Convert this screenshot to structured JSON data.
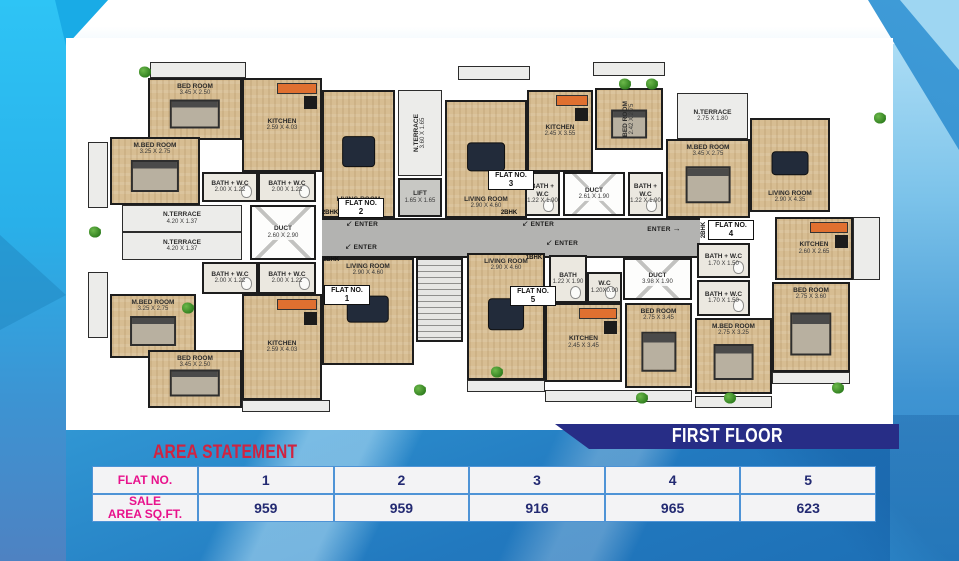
{
  "banner": {
    "title": "FIRST FLOOR"
  },
  "area_statement": {
    "title": "AREA STATEMENT",
    "rows": [
      {
        "label": "FLAT NO.",
        "cells": [
          "1",
          "2",
          "3",
          "4",
          "5"
        ]
      },
      {
        "label": "SALE\nAREA SQ.FT.",
        "cells": [
          "959",
          "959",
          "916",
          "965",
          "623"
        ]
      }
    ]
  },
  "colors": {
    "banner_navy": "#272d86",
    "title_red": "#d02340",
    "header_magenta": "#e8128c",
    "value_navy": "#232a72",
    "table_border_blue": "#4e93d6",
    "background_blue": "#35a0da",
    "left_band_cyan": "#2ec4f5"
  },
  "plan": {
    "flat_label": "FLAT NO.",
    "enter_text": "ENTER",
    "rooms": [
      {
        "t": "corridor",
        "x": 234,
        "y": 160,
        "w": 378,
        "h": 40
      },
      {
        "t": "stair",
        "x": 328,
        "y": 200,
        "w": 47,
        "h": 84
      },
      {
        "t": "terrace",
        "x": 62,
        "y": 4,
        "w": 96,
        "h": 16
      },
      {
        "t": "terrace",
        "x": 370,
        "y": 8,
        "w": 72,
        "h": 14
      },
      {
        "t": "terrace",
        "x": 505,
        "y": 4,
        "w": 72,
        "h": 14
      },
      {
        "t": "terrace",
        "x": 154,
        "y": 342,
        "w": 88,
        "h": 12
      },
      {
        "t": "terrace",
        "x": 379,
        "y": 322,
        "w": 78,
        "h": 12
      },
      {
        "t": "terrace",
        "x": 457,
        "y": 332,
        "w": 147,
        "h": 12
      },
      {
        "t": "terrace",
        "x": 607,
        "y": 338,
        "w": 77,
        "h": 12
      },
      {
        "t": "terrace",
        "x": 684,
        "y": 314,
        "w": 78,
        "h": 12
      },
      {
        "t": "terrace",
        "x": 0,
        "y": 84,
        "w": 20,
        "h": 66
      },
      {
        "t": "terrace",
        "x": 0,
        "y": 214,
        "w": 20,
        "h": 66
      },
      {
        "t": "terrace",
        "x": 765,
        "y": 159,
        "w": 27,
        "h": 63
      },
      {
        "n": "BED ROOM",
        "d": "3.45 X 2.50",
        "t": "wood",
        "f": "bed",
        "lp": "top",
        "x": 60,
        "y": 20,
        "w": 94,
        "h": 62
      },
      {
        "n": "M.BED ROOM",
        "d": "3.25 X 2.75",
        "t": "wood",
        "f": "bed",
        "lp": "top",
        "x": 22,
        "y": 79,
        "w": 90,
        "h": 68
      },
      {
        "n": "KITCHEN",
        "d": "2.59 X 4.03",
        "t": "wood",
        "f": "kit",
        "x": 154,
        "y": 20,
        "w": 80,
        "h": 94
      },
      {
        "n": "BATH + W.C",
        "d": "2.00 X 1.22",
        "t": "bath",
        "f": "wc",
        "x": 114,
        "y": 114,
        "w": 56,
        "h": 30
      },
      {
        "n": "BATH + W.C",
        "d": "2.00 X 1.22",
        "t": "bath",
        "f": "wc",
        "x": 170,
        "y": 114,
        "w": 58,
        "h": 30
      },
      {
        "n": "LIVING ROOM",
        "d": "2.90 X 4.60",
        "t": "wood",
        "f": "sofa",
        "lp": "bot",
        "x": 234,
        "y": 32,
        "w": 73,
        "h": 128
      },
      {
        "n": "N.TERRACE",
        "d": "4.20 X 1.37",
        "t": "terrace",
        "x": 34,
        "y": 147,
        "w": 120,
        "h": 27
      },
      {
        "n": "N.TERRACE",
        "d": "4.20 X 1.37",
        "t": "terrace",
        "x": 34,
        "y": 174,
        "w": 120,
        "h": 28
      },
      {
        "n": "DUCT",
        "d": "2.60 X 2.90",
        "t": "duct",
        "x": 162,
        "y": 147,
        "w": 66,
        "h": 55
      },
      {
        "n": "BATH + W.C",
        "d": "2.00 X 1.22",
        "t": "bath",
        "f": "wc",
        "x": 114,
        "y": 204,
        "w": 56,
        "h": 32
      },
      {
        "n": "BATH + W.C",
        "d": "2.00 X 1.22",
        "t": "bath",
        "f": "wc",
        "x": 170,
        "y": 204,
        "w": 58,
        "h": 32
      },
      {
        "n": "M.BED ROOM",
        "d": "3.25 X 2.75",
        "t": "wood",
        "f": "bed",
        "lp": "top",
        "x": 22,
        "y": 236,
        "w": 86,
        "h": 64
      },
      {
        "n": "BED ROOM",
        "d": "3.45 X 2.50",
        "t": "wood",
        "f": "bed",
        "lp": "top",
        "x": 60,
        "y": 292,
        "w": 94,
        "h": 58
      },
      {
        "n": "KITCHEN",
        "d": "2.59 X 4.03",
        "t": "wood",
        "f": "kit",
        "x": 154,
        "y": 236,
        "w": 80,
        "h": 106
      },
      {
        "n": "LIVING ROOM",
        "d": "2.90 X 4.60",
        "t": "wood",
        "f": "sofa",
        "lp": "top",
        "x": 234,
        "y": 200,
        "w": 92,
        "h": 107
      },
      {
        "n": "N.TERRACE",
        "d": "3.60 X 1.65",
        "t": "terrace",
        "v": 1,
        "x": 310,
        "y": 32,
        "w": 44,
        "h": 86
      },
      {
        "n": "LIFT",
        "d": "1.65 X 1.65",
        "t": "lift",
        "x": 310,
        "y": 120,
        "w": 44,
        "h": 39
      },
      {
        "n": "LIVING ROOM",
        "d": "2.90 X 4.60",
        "t": "wood",
        "f": "sofa",
        "lp": "bot",
        "x": 357,
        "y": 42,
        "w": 82,
        "h": 118
      },
      {
        "n": "KITCHEN",
        "d": "2.45 X 3.55",
        "t": "wood",
        "f": "kit",
        "x": 439,
        "y": 32,
        "w": 66,
        "h": 82
      },
      {
        "n": "BED ROOM",
        "d": "2.42 X 2.75",
        "t": "wood",
        "f": "bed",
        "v": 1,
        "x": 507,
        "y": 30,
        "w": 68,
        "h": 62
      },
      {
        "n": "BATH + W.C",
        "d": "1.22 X 1.90",
        "t": "bath",
        "f": "wc",
        "x": 437,
        "y": 114,
        "w": 35,
        "h": 44
      },
      {
        "n": "DUCT",
        "d": "2.61 X 1.90",
        "t": "duct",
        "x": 475,
        "y": 114,
        "w": 62,
        "h": 44
      },
      {
        "n": "BATH + W.C",
        "d": "1.22 X 1.90",
        "t": "bath",
        "f": "wc",
        "x": 540,
        "y": 114,
        "w": 35,
        "h": 44
      },
      {
        "n": "N.TERRACE",
        "d": "2.75 X 1.80",
        "t": "terrace",
        "x": 589,
        "y": 35,
        "w": 71,
        "h": 46
      },
      {
        "n": "M.BED ROOM",
        "d": "3.45 X 2.75",
        "t": "wood",
        "f": "bed",
        "lp": "top",
        "x": 578,
        "y": 81,
        "w": 84,
        "h": 79
      },
      {
        "n": "LIVING ROOM",
        "d": "2.90 X 4.35",
        "t": "wood",
        "f": "sofa",
        "lp": "bot",
        "x": 662,
        "y": 60,
        "w": 80,
        "h": 94
      },
      {
        "n": "KITCHEN",
        "d": "2.60 X 2.65",
        "t": "wood",
        "f": "kit",
        "x": 687,
        "y": 159,
        "w": 78,
        "h": 63
      },
      {
        "n": "BATH + W.C",
        "d": "1.70 X 1.50",
        "t": "bath",
        "f": "wc",
        "x": 609,
        "y": 185,
        "w": 53,
        "h": 35
      },
      {
        "n": "BATH + W.C",
        "d": "1.70 X 1.50",
        "t": "bath",
        "f": "wc",
        "x": 609,
        "y": 222,
        "w": 53,
        "h": 36
      },
      {
        "n": "M.BED ROOM",
        "d": "2.75 X 3.25",
        "t": "wood",
        "f": "bed",
        "lp": "top",
        "x": 607,
        "y": 260,
        "w": 77,
        "h": 76
      },
      {
        "n": "BED ROOM",
        "d": "2.75 X 3.60",
        "t": "wood",
        "f": "bed",
        "lp": "top",
        "x": 684,
        "y": 224,
        "w": 78,
        "h": 90
      },
      {
        "n": "LIVING ROOM",
        "d": "2.90 X 4.60",
        "t": "wood",
        "f": "sofa",
        "lp": "top",
        "x": 379,
        "y": 195,
        "w": 78,
        "h": 127
      },
      {
        "n": "BATH",
        "d": "1.22 X 1.90",
        "t": "bath",
        "f": "wc",
        "x": 461,
        "y": 197,
        "w": 38,
        "h": 48
      },
      {
        "n": "W.C",
        "d": "1.20X0.90",
        "t": "bath",
        "f": "wc",
        "x": 499,
        "y": 214,
        "w": 35,
        "h": 31
      },
      {
        "n": "DUCT",
        "d": "3.98 X 1.90",
        "t": "duct",
        "x": 535,
        "y": 200,
        "w": 69,
        "h": 42
      },
      {
        "n": "KITCHEN",
        "d": "2.45 X 3.45",
        "t": "wood",
        "f": "kit",
        "x": 457,
        "y": 245,
        "w": 77,
        "h": 79
      },
      {
        "n": "BED ROOM",
        "d": "2.75 X 3.45",
        "t": "wood",
        "f": "bed",
        "lp": "top",
        "x": 537,
        "y": 245,
        "w": 67,
        "h": 85
      }
    ],
    "flat_tags": [
      {
        "num": "2",
        "x": 250,
        "y": 140
      },
      {
        "num": "1",
        "x": 236,
        "y": 227
      },
      {
        "num": "3",
        "x": 400,
        "y": 112
      },
      {
        "num": "4",
        "x": 620,
        "y": 162
      },
      {
        "num": "5",
        "x": 422,
        "y": 228
      }
    ],
    "bhk_tags": [
      {
        "label": "2BHK",
        "x": 242,
        "y": 155
      },
      {
        "label": "2BHK",
        "x": 243,
        "y": 202
      },
      {
        "label": "2BHK",
        "x": 421,
        "y": 155
      },
      {
        "label": "1BHK",
        "x": 446,
        "y": 200
      },
      {
        "label": "2BHK",
        "x": 616,
        "y": 172,
        "v": 1
      }
    ],
    "enter_labels": [
      {
        "x": 274,
        "y": 166,
        "dir": "sw"
      },
      {
        "x": 273,
        "y": 189,
        "dir": "sw"
      },
      {
        "x": 450,
        "y": 166,
        "dir": "sw"
      },
      {
        "x": 474,
        "y": 185,
        "dir": "sw"
      },
      {
        "x": 576,
        "y": 171,
        "dir": "e"
      }
    ],
    "plants": [
      {
        "x": 57,
        "y": 14
      },
      {
        "x": 537,
        "y": 26
      },
      {
        "x": 564,
        "y": 26
      },
      {
        "x": 792,
        "y": 60
      },
      {
        "x": 7,
        "y": 174
      },
      {
        "x": 100,
        "y": 250
      },
      {
        "x": 409,
        "y": 314
      },
      {
        "x": 332,
        "y": 332
      },
      {
        "x": 554,
        "y": 340
      },
      {
        "x": 642,
        "y": 340
      },
      {
        "x": 750,
        "y": 330
      }
    ]
  }
}
